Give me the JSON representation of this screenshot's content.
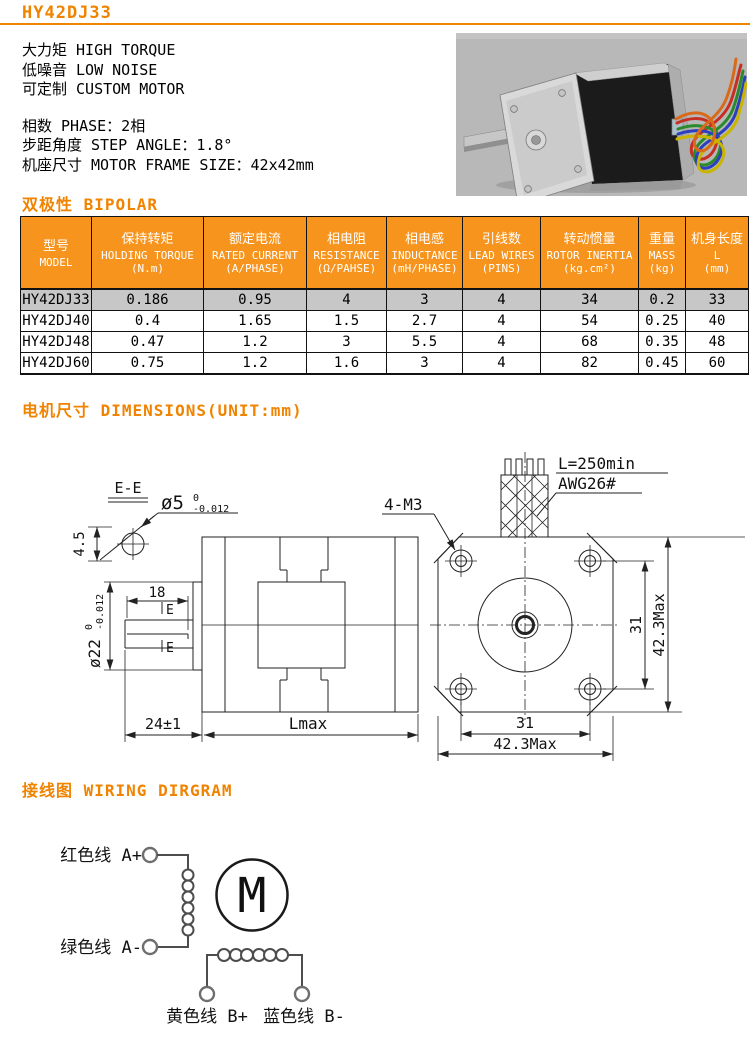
{
  "colors": {
    "accent_orange": "#F08300",
    "table_header_bg": "#F7941D",
    "highlight_row_bg": "#C7C7C7",
    "photo_background": "#B8B8B8"
  },
  "header": {
    "title": "HY42DJ33"
  },
  "intro": {
    "features": [
      "大力矩 HIGH TORQUE",
      "低噪音 LOW NOISE",
      "可定制 CUSTOM MOTOR"
    ],
    "specs": [
      "相数 PHASE：2相",
      "步距角度 STEP ANGLE：1.8°",
      "机座尺寸 MOTOR FRAME SIZE：42x42mm"
    ]
  },
  "sections": {
    "bipolar": "双极性 BIPOLAR",
    "dimensions": "电机尺寸 DIMENSIONS(UNIT:mm)",
    "wiring": "接线图 WIRING DIRGRAM"
  },
  "table": {
    "headers": [
      {
        "cn": "型号",
        "en": "MODEL",
        "unit": ""
      },
      {
        "cn": "保持转矩",
        "en": "HOLDING TORQUE",
        "unit": "(N.m)"
      },
      {
        "cn": "额定电流",
        "en": "RATED CURRENT",
        "unit": "(A/PHASE)"
      },
      {
        "cn": "相电阻",
        "en": "RESISTANCE",
        "unit": "(Ω/PAHSE)"
      },
      {
        "cn": "相电感",
        "en": "INDUCTANCE",
        "unit": "(mH/PHASE)"
      },
      {
        "cn": "引线数",
        "en": "LEAD WIRES",
        "unit": "(PINS)"
      },
      {
        "cn": "转动惯量",
        "en": "ROTOR INERTIA",
        "unit": "(kg.cm²)"
      },
      {
        "cn": "重量",
        "en": "MASS",
        "unit": "(kg)"
      },
      {
        "cn": "机身长度",
        "en": "L",
        "unit": "(mm)"
      }
    ],
    "rows": [
      {
        "model": "HY42DJ33",
        "values": [
          "0.186",
          "0.95",
          "4",
          "3",
          "4",
          "34",
          "0.2",
          "33"
        ]
      },
      {
        "model": "HY42DJ40",
        "values": [
          "0.4",
          "1.65",
          "1.5",
          "2.7",
          "4",
          "54",
          "0.25",
          "40"
        ]
      },
      {
        "model": "HY42DJ48",
        "values": [
          "0.47",
          "1.2",
          "3",
          "5.5",
          "4",
          "68",
          "0.35",
          "48"
        ]
      },
      {
        "model": "HY42DJ60",
        "values": [
          "0.75",
          "1.2",
          "1.6",
          "3",
          "4",
          "82",
          "0.45",
          "60"
        ]
      }
    ]
  },
  "drawing": {
    "section_label": "E-E",
    "flat_height": "4.5",
    "shaft_dia": "ø5",
    "shaft_tol_upper": "0",
    "shaft_tol_lower": "-0.012",
    "key_length": "18",
    "section_mark_top": "E",
    "section_mark_bottom": "E",
    "pilot_dia": "ø22",
    "pilot_tol_upper": "0",
    "pilot_tol_lower": "-0.012",
    "shaft_length": "24±1",
    "body_length": "Lmax",
    "mount_holes": "4-M3",
    "lead_length": "L=250min",
    "lead_gauge": "AWG26#",
    "hole_spacing_vertical": "31",
    "frame_height": "42.3Max",
    "hole_spacing_horizontal": "31",
    "frame_width": "42.3Max"
  },
  "wiring": {
    "motor_symbol": "M",
    "phase_a_plus": "红色线 A+",
    "phase_a_minus": "绿色线 A-",
    "phase_b_plus": "黄色线 B+",
    "phase_b_minus": "蓝色线 B-"
  }
}
